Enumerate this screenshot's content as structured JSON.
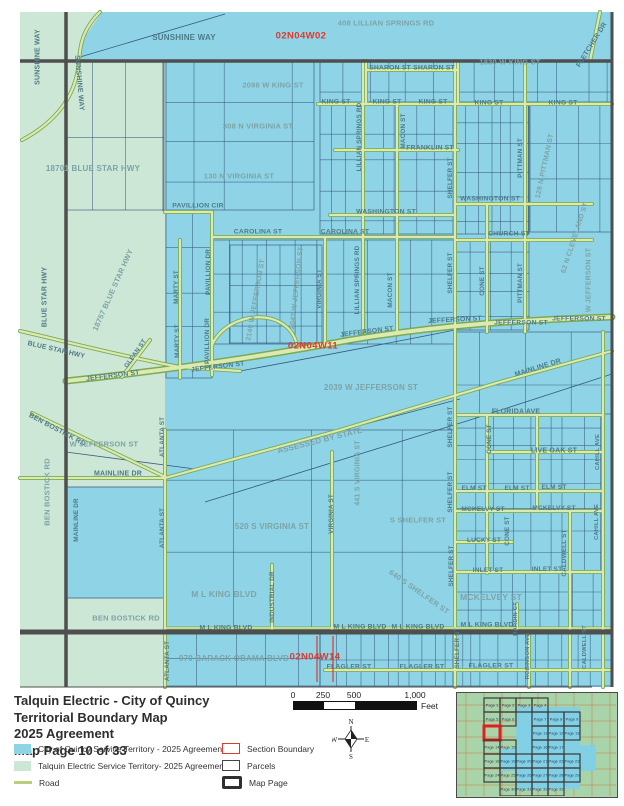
{
  "map": {
    "colors": {
      "quincy_blue": "#8ed4e6",
      "talquin_green": "#cde7d6",
      "road_fill": "#dce9b2",
      "road_casing": "#79ab52",
      "parcel_line": "#2e4d73",
      "major_road_dark": "#4f4f4f",
      "section_red": "#e0392d",
      "label_teal": "#4e7b87"
    },
    "section_labels": [
      {
        "t": "02N04W02",
        "x": 301,
        "y": 36
      },
      {
        "t": "02N04W11",
        "x": 313,
        "y": 346
      },
      {
        "t": "02N04W14",
        "x": 315,
        "y": 657
      }
    ],
    "street_labels": [
      {
        "t": "SUNSHINE WAY",
        "x": 38,
        "y": 57,
        "r": -90,
        "s": 7
      },
      {
        "t": "SUNSHINE WAY",
        "x": 79,
        "y": 83,
        "r": 85,
        "s": 7
      },
      {
        "t": "SUNSHINE WAY",
        "x": 184,
        "y": 38,
        "s": 8
      },
      {
        "t": "408 LILLIAN SPRINGS RD",
        "x": 386,
        "y": 23,
        "s": 7.5,
        "m": 1
      },
      {
        "t": "1830 W KING ST",
        "x": 510,
        "y": 62,
        "s": 7.5,
        "m": 1
      },
      {
        "t": "FLETCHER DR",
        "x": 592,
        "y": 45,
        "r": -58,
        "s": 7
      },
      {
        "t": "SHARON ST",
        "x": 390,
        "y": 69,
        "s": 6.8
      },
      {
        "t": "SHARON ST",
        "x": 434,
        "y": 69,
        "s": 6.8
      },
      {
        "t": "2098 W KING ST",
        "x": 273,
        "y": 85,
        "s": 7.5,
        "m": 1
      },
      {
        "t": "KING ST",
        "x": 336,
        "y": 103,
        "s": 6.8
      },
      {
        "t": "KING ST",
        "x": 387,
        "y": 103,
        "s": 6.8
      },
      {
        "t": "KING ST",
        "x": 433,
        "y": 103,
        "s": 6.8
      },
      {
        "t": "KING ST",
        "x": 489,
        "y": 104,
        "s": 6.8
      },
      {
        "t": "KING ST",
        "x": 563,
        "y": 104,
        "s": 6.8
      },
      {
        "t": "308 N VIRGINIA ST",
        "x": 258,
        "y": 126,
        "s": 7.5,
        "m": 1
      },
      {
        "t": "LILLIAN SPRINGS RD",
        "x": 360,
        "y": 137,
        "r": -90,
        "s": 6.3
      },
      {
        "t": "MACON ST",
        "x": 404,
        "y": 131,
        "r": -90,
        "s": 6.3
      },
      {
        "t": "FRANKLIN ST",
        "x": 430,
        "y": 149,
        "s": 6.8
      },
      {
        "t": "130 N VIRGINIA ST",
        "x": 239,
        "y": 176,
        "s": 7.5,
        "m": 1
      },
      {
        "t": "18701 BLUE STAR HWY",
        "x": 93,
        "y": 169,
        "s": 8,
        "m": 1
      },
      {
        "t": "PITTMAN ST",
        "x": 521,
        "y": 158,
        "r": -90,
        "s": 6.3
      },
      {
        "t": "129 N PITTMAN ST",
        "x": 545,
        "y": 166,
        "r": -78,
        "s": 7,
        "m": 1
      },
      {
        "t": "SHELFER ST",
        "x": 451,
        "y": 178,
        "r": -90,
        "s": 6.3
      },
      {
        "t": "WASHINGTON ST",
        "x": 490,
        "y": 200,
        "s": 6.8
      },
      {
        "t": "WASHINGTON ST",
        "x": 386,
        "y": 213,
        "s": 6.8
      },
      {
        "t": "PAVILLION CIR",
        "x": 198,
        "y": 207,
        "s": 6.8
      },
      {
        "t": "CAROLINA ST",
        "x": 258,
        "y": 233,
        "s": 6.8
      },
      {
        "t": "CAROLINA ST",
        "x": 345,
        "y": 233,
        "s": 6.8
      },
      {
        "t": "CHURCH ST",
        "x": 509,
        "y": 235,
        "s": 6.8
      },
      {
        "t": "MARTY ST",
        "x": 177,
        "y": 287,
        "r": -90,
        "s": 6.3
      },
      {
        "t": "MARTY ST",
        "x": 178,
        "y": 341,
        "r": -90,
        "s": 6.3
      },
      {
        "t": "PAVILLION DR",
        "x": 209,
        "y": 272,
        "r": -90,
        "s": 6.3
      },
      {
        "t": "PAVILLION DR",
        "x": 208,
        "y": 341,
        "r": -90,
        "s": 6.3
      },
      {
        "t": "2140 W JEFFERSON ST",
        "x": 256,
        "y": 300,
        "r": -80,
        "s": 7,
        "m": 1
      },
      {
        "t": "2042 W JEFFERSON ST",
        "x": 297,
        "y": 288,
        "r": -84,
        "s": 7,
        "m": 1
      },
      {
        "t": "VIRGINIA ST",
        "x": 320,
        "y": 289,
        "r": -90,
        "s": 6.3
      },
      {
        "t": "LILLIAN SPRINGS RD",
        "x": 358,
        "y": 280,
        "r": -90,
        "s": 6.3
      },
      {
        "t": "MACON ST",
        "x": 391,
        "y": 290,
        "r": -90,
        "s": 6.3
      },
      {
        "t": "SHELFER ST",
        "x": 451,
        "y": 273,
        "r": -90,
        "s": 6.3
      },
      {
        "t": "CONE ST",
        "x": 483,
        "y": 281,
        "r": -90,
        "s": 6.3
      },
      {
        "t": "PITTMAN ST",
        "x": 521,
        "y": 283,
        "r": -90,
        "s": 6.3
      },
      {
        "t": "62 N CLEVELAND ST",
        "x": 575,
        "y": 238,
        "r": -72,
        "s": 7,
        "m": 1
      },
      {
        "t": "W JEFFERSON ST",
        "x": 589,
        "y": 280,
        "r": -90,
        "s": 7,
        "m": 1
      },
      {
        "t": "BLUE STAR HWY",
        "x": 45,
        "y": 297,
        "r": -90,
        "s": 7
      },
      {
        "t": "18757 BLUE STAR HWY",
        "x": 113,
        "y": 290,
        "r": -66,
        "s": 7.5,
        "m": 1
      },
      {
        "t": "BLUE STAR HWY",
        "x": 56,
        "y": 351,
        "r": 13,
        "s": 6.8
      },
      {
        "t": "GLEAN ST",
        "x": 136,
        "y": 354,
        "r": -55,
        "s": 6.3
      },
      {
        "t": "JEFFERSON ST",
        "x": 113,
        "y": 377,
        "r": -7,
        "s": 6.8
      },
      {
        "t": "JEFFERSON ST",
        "x": 218,
        "y": 368,
        "r": -7,
        "s": 6.8
      },
      {
        "t": "JEFFERSON ST",
        "x": 367,
        "y": 333,
        "r": -7,
        "s": 6.8
      },
      {
        "t": "JEFFERSON ST",
        "x": 455,
        "y": 321,
        "r": -3,
        "s": 6.8
      },
      {
        "t": "JEFFERSON ST",
        "x": 521,
        "y": 324,
        "s": 6.8
      },
      {
        "t": "JEFFERSON ST",
        "x": 579,
        "y": 320,
        "s": 6.8
      },
      {
        "t": "2039 W JEFFERSON ST",
        "x": 371,
        "y": 388,
        "s": 8,
        "m": 1
      },
      {
        "t": "MAINLINE DR",
        "x": 538,
        "y": 368,
        "r": -17,
        "s": 7
      },
      {
        "t": "BEN BOSTICK RD",
        "x": 57,
        "y": 430,
        "r": 28,
        "s": 7
      },
      {
        "t": "W JEFFERSON ST",
        "x": 104,
        "y": 444,
        "s": 7.5,
        "m": 1
      },
      {
        "t": "ATLANTA ST",
        "x": 163,
        "y": 437,
        "r": -90,
        "s": 6.3
      },
      {
        "t": "MAINLINE DR",
        "x": 118,
        "y": 474,
        "s": 7
      },
      {
        "t": "MAINLINE DR",
        "x": 77,
        "y": 520,
        "r": -90,
        "s": 6.3
      },
      {
        "t": "BEN BOSTICK RD",
        "x": 47,
        "y": 492,
        "r": -90,
        "s": 7.5,
        "m": 1
      },
      {
        "t": "ATLANTA ST",
        "x": 163,
        "y": 528,
        "r": -90,
        "s": 6.3
      },
      {
        "t": "ASSESSED BY STATE",
        "x": 320,
        "y": 441,
        "r": -14,
        "s": 8,
        "m": 1
      },
      {
        "t": "441 S VIRGINIA ST",
        "x": 358,
        "y": 473,
        "r": -90,
        "s": 7,
        "m": 1
      },
      {
        "t": "VIRGINIA ST",
        "x": 332,
        "y": 514,
        "r": -90,
        "s": 6.3
      },
      {
        "t": "520 S VIRGINIA ST",
        "x": 272,
        "y": 527,
        "s": 8,
        "m": 1
      },
      {
        "t": "SHELFER ST",
        "x": 451,
        "y": 427,
        "r": -90,
        "s": 6.3
      },
      {
        "t": "SHELFER ST",
        "x": 451,
        "y": 492,
        "r": -90,
        "s": 6.3
      },
      {
        "t": "FLORIDA AVE",
        "x": 516,
        "y": 412,
        "s": 7
      },
      {
        "t": "CONE ST",
        "x": 490,
        "y": 439,
        "r": -90,
        "s": 6.3
      },
      {
        "t": "LIVE OAK ST",
        "x": 554,
        "y": 451,
        "s": 7
      },
      {
        "t": "ELM ST",
        "x": 474,
        "y": 489,
        "s": 6.5
      },
      {
        "t": "ELM ST",
        "x": 517,
        "y": 489,
        "s": 6.5
      },
      {
        "t": "ELM ST",
        "x": 554,
        "y": 488,
        "s": 6.5
      },
      {
        "t": "MCKELVY ST",
        "x": 483,
        "y": 510,
        "s": 6.5
      },
      {
        "t": "MCKELVY ST",
        "x": 554,
        "y": 509,
        "s": 6.5
      },
      {
        "t": "S SHELFER ST",
        "x": 418,
        "y": 520,
        "s": 7.5,
        "m": 1
      },
      {
        "t": "LUCKY ST",
        "x": 484,
        "y": 541,
        "s": 6.5
      },
      {
        "t": "CONE ST",
        "x": 508,
        "y": 531,
        "r": -90,
        "s": 6.3
      },
      {
        "t": "INLET ST",
        "x": 488,
        "y": 571,
        "s": 6.5
      },
      {
        "t": "INLET ST",
        "x": 547,
        "y": 570,
        "s": 6.5
      },
      {
        "t": "CALDWELL ST",
        "x": 565,
        "y": 553,
        "r": -90,
        "s": 6.3
      },
      {
        "t": "MCKELVEY ST",
        "x": 491,
        "y": 597,
        "s": 8.5,
        "m": 1
      },
      {
        "t": "640 S SHELFER ST",
        "x": 419,
        "y": 592,
        "r": 35,
        "s": 7.5,
        "m": 1
      },
      {
        "t": "SHELFER ST",
        "x": 452,
        "y": 566,
        "r": -90,
        "s": 6.3
      },
      {
        "t": "SHELFER ST",
        "x": 458,
        "y": 648,
        "r": -90,
        "s": 6.3
      },
      {
        "t": "M L KING BLVD",
        "x": 224,
        "y": 594,
        "s": 8.5,
        "m": 1
      },
      {
        "t": "INDUSTRIAL DR",
        "x": 273,
        "y": 597,
        "r": -90,
        "s": 6.3
      },
      {
        "t": "M L KING BLVD",
        "x": 226,
        "y": 629,
        "s": 6.8
      },
      {
        "t": "M L KING BLVD",
        "x": 360,
        "y": 628,
        "s": 6.8
      },
      {
        "t": "M L KING BLVD",
        "x": 418,
        "y": 628,
        "s": 6.8
      },
      {
        "t": "M L KING BLVD",
        "x": 487,
        "y": 626,
        "s": 6.8
      },
      {
        "t": "BEN BOSTICK RD",
        "x": 126,
        "y": 618,
        "s": 7.5,
        "m": 1
      },
      {
        "t": "ATLANTA ST",
        "x": 168,
        "y": 661,
        "r": -90,
        "s": 6.3
      },
      {
        "t": "970 BARACK OBAMA BLVD",
        "x": 234,
        "y": 659,
        "s": 8,
        "m": 1
      },
      {
        "t": "FLAGLER ST",
        "x": 349,
        "y": 668,
        "s": 6.8
      },
      {
        "t": "FLAGLER ST",
        "x": 422,
        "y": 668,
        "s": 6.8
      },
      {
        "t": "FLAGLER ST",
        "x": 491,
        "y": 667,
        "s": 6.8
      },
      {
        "t": "HARDIN CT",
        "x": 517,
        "y": 619,
        "r": -90,
        "s": 5.8
      },
      {
        "t": "ROBINSON AVE",
        "x": 529,
        "y": 656,
        "r": -90,
        "s": 5.8
      },
      {
        "t": "CALDWELL ST",
        "x": 586,
        "y": 647,
        "r": -90,
        "s": 5.8
      },
      {
        "t": "CAHILL AVE",
        "x": 599,
        "y": 452,
        "r": -90,
        "s": 5.8
      },
      {
        "t": "CAHILL AVE",
        "x": 598,
        "y": 522,
        "r": -90,
        "s": 5.8
      }
    ]
  },
  "legend": {
    "title_lines": [
      "Talquin Electric - City of Quincy",
      "Territorial Boundary Map",
      "2025 Agreement",
      "Map Page 10 of 33"
    ],
    "items_left": [
      {
        "label": "City of Quincy Service Territory - 2025 Agreement",
        "swatch": "quincy"
      },
      {
        "label": "Talquin Electric Service Territory- 2025 Agreement",
        "swatch": "talquin"
      },
      {
        "label": "Road",
        "swatch": "road"
      }
    ],
    "items_right": [
      {
        "label": "Section Boundary",
        "swatch": "section"
      },
      {
        "label": "Parcels",
        "swatch": "parcels"
      },
      {
        "label": "Map Page",
        "swatch": "mappage"
      }
    ],
    "scale": {
      "ticks": [
        "0",
        "250",
        "500",
        "1,000"
      ],
      "unit": "Feet"
    },
    "compass": {
      "n": "N",
      "e": "E",
      "s": "S",
      "w": "W"
    }
  },
  "inset": {
    "current_page": "Page 10",
    "pages": [
      {
        "label": "Page 1",
        "c": 0,
        "r": 0
      },
      {
        "label": "Page 2",
        "c": 1,
        "r": 0
      },
      {
        "label": "Page 3",
        "c": 2,
        "r": 0
      },
      {
        "label": "Page 4",
        "c": 3,
        "r": 0
      },
      {
        "label": "Page 5",
        "c": 0,
        "r": 1
      },
      {
        "label": "Page 6",
        "c": 1,
        "r": 1
      },
      {
        "label": "Page 7",
        "c": 3,
        "r": 1
      },
      {
        "label": "Page 8",
        "c": 4,
        "r": 1
      },
      {
        "label": "Page 9",
        "c": 5,
        "r": 1
      },
      {
        "label": "Page 10",
        "c": 0,
        "r": 2,
        "cur": 1
      },
      {
        "label": "Page 11",
        "c": 3,
        "r": 2
      },
      {
        "label": "Page 12",
        "c": 4,
        "r": 2
      },
      {
        "label": "Page 13",
        "c": 5,
        "r": 2
      },
      {
        "label": "Page 14",
        "c": 0,
        "r": 3
      },
      {
        "label": "Page 15",
        "c": 1,
        "r": 3
      },
      {
        "label": "Page 16",
        "c": 3,
        "r": 3
      },
      {
        "label": "Page 17",
        "c": 4,
        "r": 3
      },
      {
        "label": "Page 18",
        "c": 0,
        "r": 4
      },
      {
        "label": "Page 19",
        "c": 1,
        "r": 4
      },
      {
        "label": "Page 20",
        "c": 2,
        "r": 4
      },
      {
        "label": "Page 21",
        "c": 3,
        "r": 4
      },
      {
        "label": "Page 22",
        "c": 4,
        "r": 4
      },
      {
        "label": "Page 23",
        "c": 5,
        "r": 4
      },
      {
        "label": "Page 24",
        "c": 0,
        "r": 5
      },
      {
        "label": "Page 25",
        "c": 1,
        "r": 5
      },
      {
        "label": "Page 26",
        "c": 2,
        "r": 5
      },
      {
        "label": "Page 27",
        "c": 3,
        "r": 5
      },
      {
        "label": "Page 28",
        "c": 4,
        "r": 5
      },
      {
        "label": "Page 29",
        "c": 5,
        "r": 5
      },
      {
        "label": "Page 30",
        "c": 1,
        "r": 6
      },
      {
        "label": "Page 31",
        "c": 2,
        "r": 6
      },
      {
        "label": "Page 32",
        "c": 3,
        "r": 6
      },
      {
        "label": "Page 33",
        "c": 4,
        "r": 6
      }
    ]
  }
}
